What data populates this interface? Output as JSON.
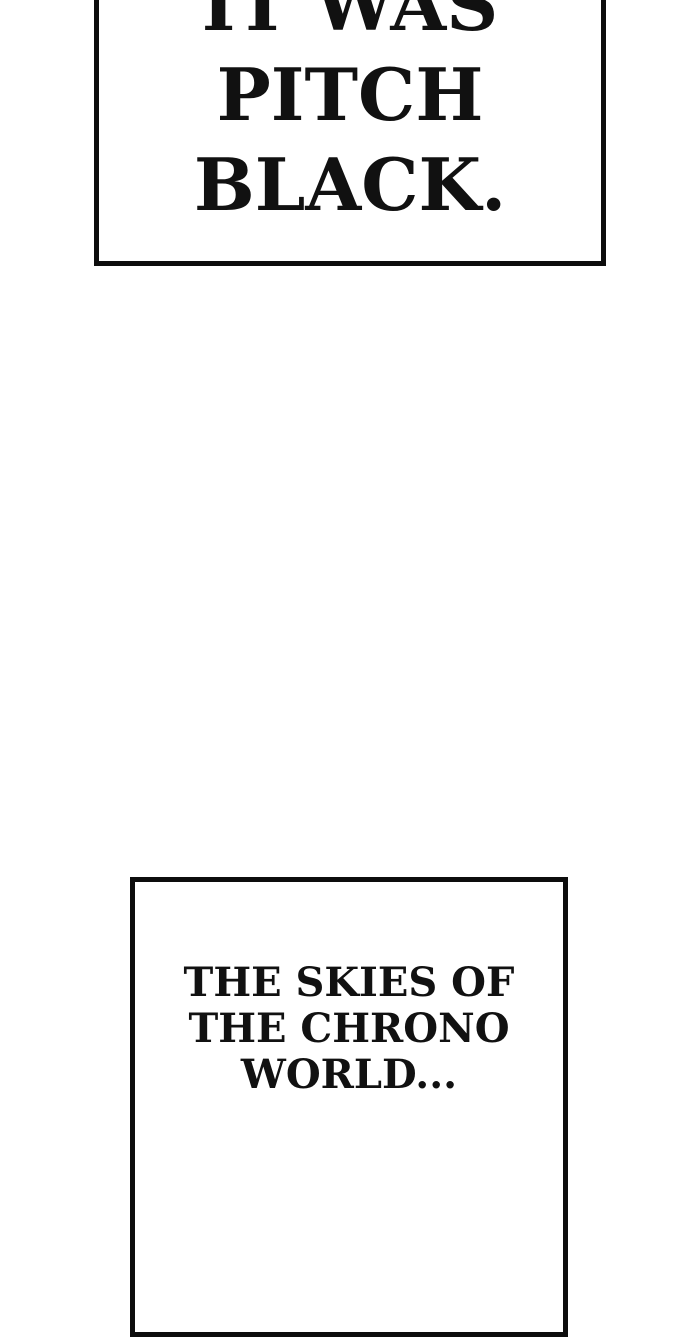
{
  "page": {
    "background_color": "#ffffff",
    "ink_color": "#111111",
    "border_color": "#0d0d0d"
  },
  "captions": {
    "top": {
      "line1": "IT WAS",
      "line2": "PITCH",
      "line3": "BLACK."
    },
    "bottom": {
      "line1": "THE SKIES OF",
      "line2": "THE CHRONO",
      "line3": "WORLD..."
    }
  }
}
